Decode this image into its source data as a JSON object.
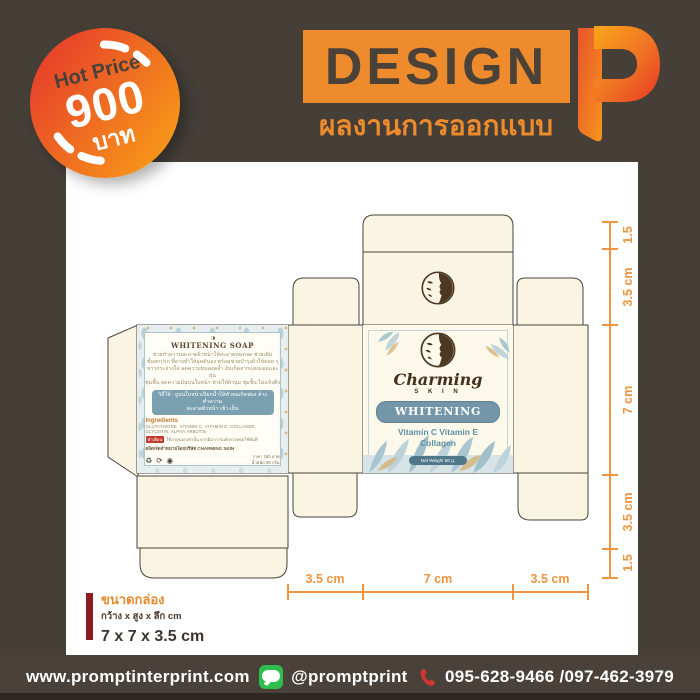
{
  "badge": {
    "line1": "Hot Price",
    "line2": "900",
    "line3": "บาท"
  },
  "brand": {
    "title": "DESIGN",
    "subtitle": "ผลงานการออกแบบ"
  },
  "dieline": {
    "back_panel": {
      "title": "WHITENING SOAP",
      "desc_lines": [
        "ช่วยทำความสะอาดผิวหน้าให้สะอาดหมดจด ช่วยเติม",
        "ชั้นสกปรก ที่อาจทำให้อุดตันลง พร้อมช่วยบำรุงผิวให้ค่อย ๆ",
        "ขาวกระจ่างใส ลดความหมองคล้ำ อันเกิดจากแสงแดดและฝุ่น",
        "ชุ่มชื้น ลดความมันบนใบหน้า ช่วยให้ผิวนุ่ม ชุ่มชื้น ไม่แห้งตึง"
      ],
      "usage_line1": "วิธีใช้ : ถูบนใบหน้าเปียกน้ำให้ทั่วจนเกิดฟอง ล้างทำความ",
      "usage_line2": "สะอาดผิวหน้า เช้า-เย็น",
      "ingredients_label": "Ingredients",
      "ingredients": "GLUTATHIONE, VITAMIN C, VITAMIN E, COLLAGEN, GLYCERIN, ALPHA ARBUTIN",
      "warning_tag": "คำเตือน",
      "warning_text": "ใช้ภายนอกเท่านั้น หากมีอาการแพ้ ควรหยุดใช้ทันที",
      "producer": "ผลิต/จัดจำหน่ายโดยบริษัท CHARMING SKIN",
      "icons": "♻ ⟳ ◉",
      "price_line1": "ราคา 160 บาท",
      "price_line2": "น้ำหนัก 80 กรัม"
    },
    "front_panel": {
      "brand_script": "Charming",
      "brand_sub": "S K I N",
      "product": "WHITENING SOAP",
      "subtitle_1": "Vitamin C Vitamin E",
      "subtitle_2": "Collagen",
      "net_weight": "Net Weight 80 g."
    },
    "dimensions": {
      "right": [
        "1.5",
        "3.5 cm",
        "7 cm",
        "3.5 cm",
        "1.5"
      ],
      "bottom": [
        "3.5 cm",
        "7 cm",
        "3.5 cm"
      ]
    }
  },
  "size_info": {
    "title": "ขนาดกล่อง",
    "subtitle": "กว้าง x สูง x ลึก cm",
    "value": "7 x 7 x 3.5 cm"
  },
  "footer": {
    "website": "www.promptinterprint.com",
    "line_id": "@promptprint",
    "phone": "095-628-9466 /097-462-3979"
  },
  "colors": {
    "background": "#453f38",
    "accent_orange": "#ee8b2c",
    "dimension_orange": "#ef9440",
    "badge_red": "#e63b2b",
    "badge_orange": "#f89c18",
    "cream_panel": "#faf4e3",
    "teal": "#7397a9",
    "dark_red_bar": "#8a1d21",
    "line_green": "#2fbe4e",
    "phone_red": "#d2372e"
  }
}
